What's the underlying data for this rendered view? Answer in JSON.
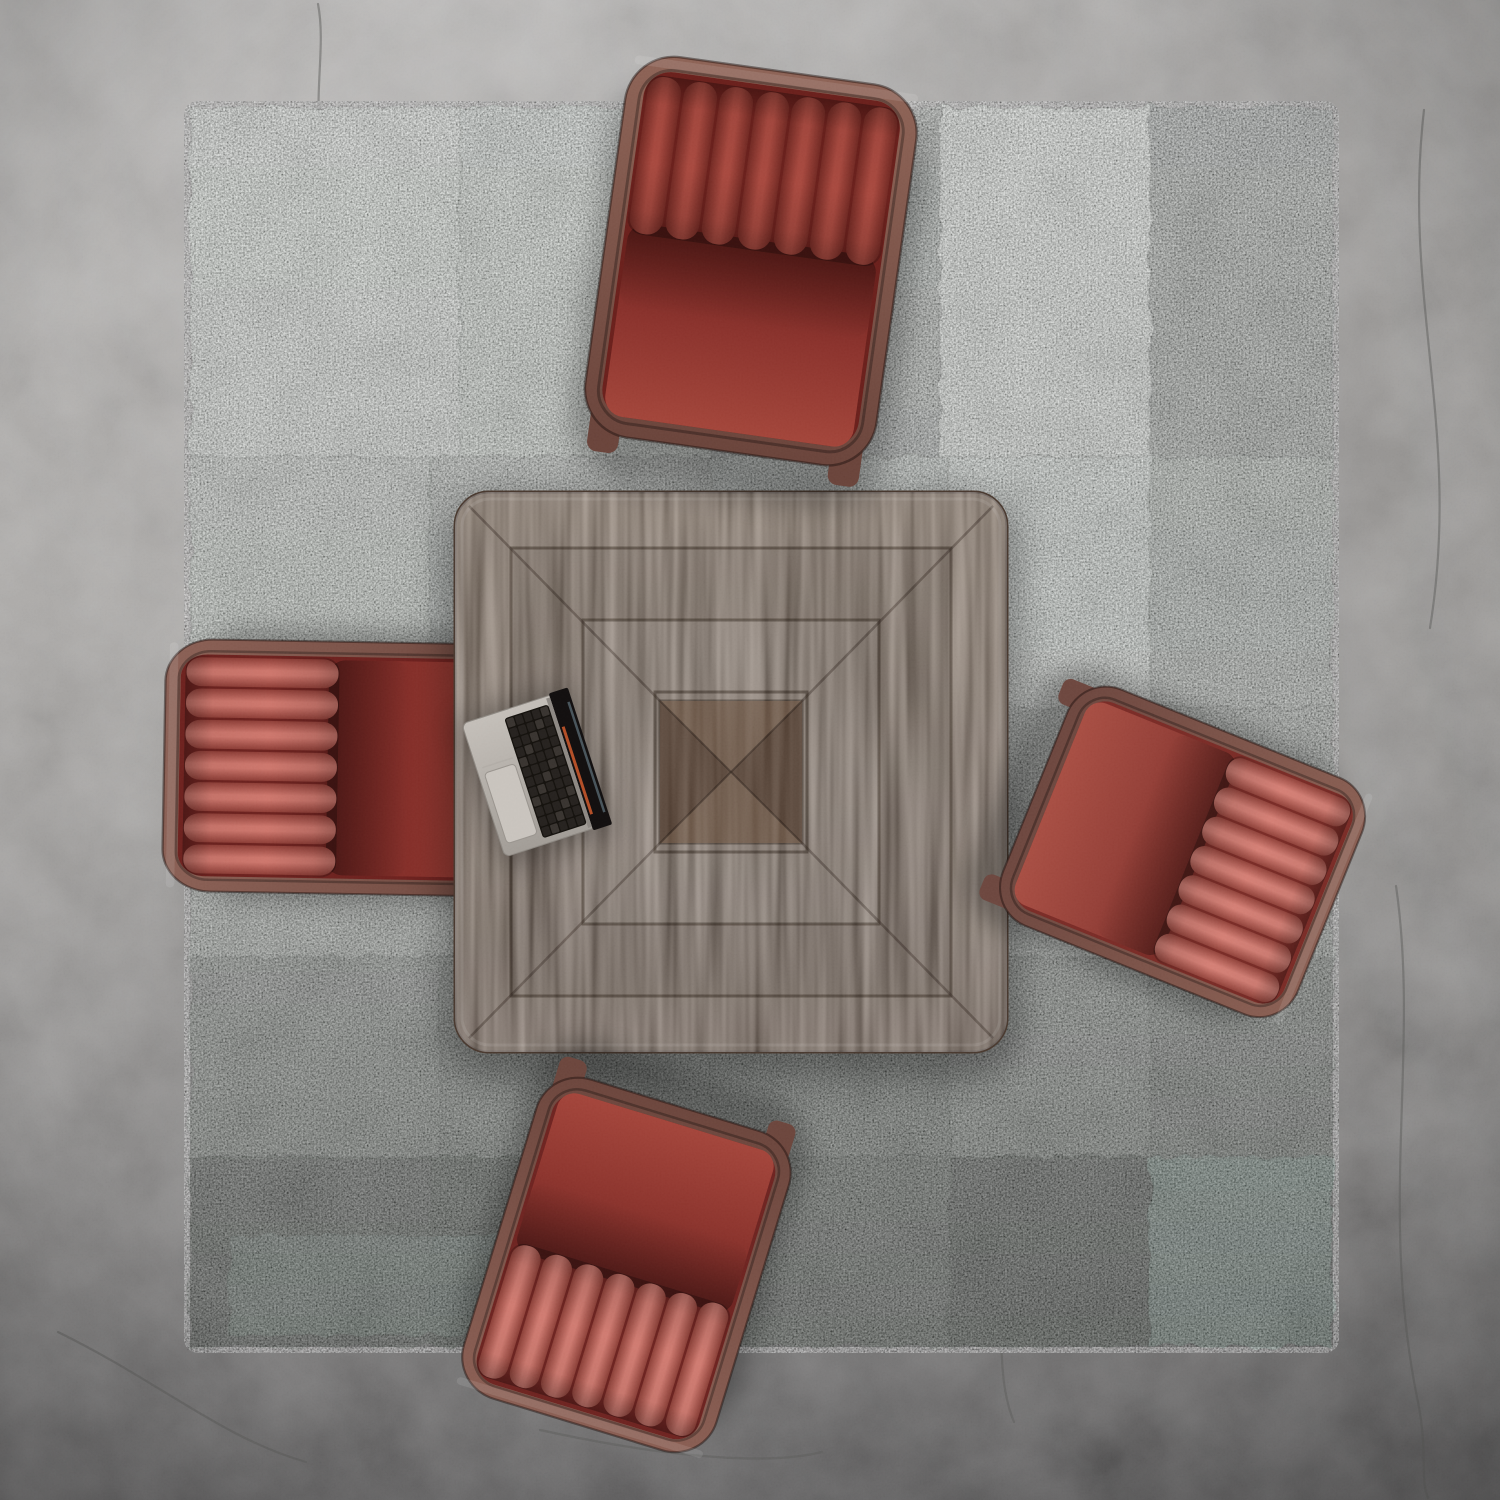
{
  "scene": {
    "description": "Top-down render: square walnut marquetry table with an open laptop, surrounded by four red leather channel-tufted wood-frame armchairs, on a distressed grey patchwork rug over a cracked concrete floor",
    "canvas": {
      "w": 1500,
      "h": 1500
    },
    "floor": {
      "base": "#a6a4a2",
      "crack": "#5e5d5b",
      "cracks": [
        "M318,4 C330,66 296,140 352,228",
        "M1424,110 C1402,300 1462,430 1430,628",
        "M1396,886 C1420,1050 1378,1210 1418,1402 C1428,1452 1420,1480 1428,1498",
        "M58,1332 C160,1382 222,1438 306,1462",
        "M540,1430 C640,1452 758,1468 822,1452",
        "M986,1236 C1010,1300 992,1370 1014,1422"
      ]
    },
    "rug": {
      "x": 190,
      "y": 107,
      "w": 1143,
      "h": 1240,
      "base": "#b4bab4",
      "seam": "rgba(25,30,25,0.13)",
      "patches": [
        {
          "x": 0,
          "y": 0,
          "w": 270,
          "h": 350,
          "c": "#d4dad4"
        },
        {
          "x": 270,
          "y": 0,
          "w": 250,
          "h": 350,
          "c": "#c7cfc8"
        },
        {
          "x": 520,
          "y": 0,
          "w": 230,
          "h": 350,
          "c": "#9ba19c"
        },
        {
          "x": 750,
          "y": 0,
          "w": 210,
          "h": 350,
          "c": "#d8ded8"
        },
        {
          "x": 960,
          "y": 0,
          "w": 183,
          "h": 350,
          "c": "#8e948f"
        },
        {
          "x": 0,
          "y": 350,
          "w": 240,
          "h": 250,
          "c": "#c1c8c2"
        },
        {
          "x": 240,
          "y": 350,
          "w": 280,
          "h": 250,
          "c": "#abb2ac"
        },
        {
          "x": 520,
          "y": 350,
          "w": 240,
          "h": 250,
          "c": "#b7beb8"
        },
        {
          "x": 760,
          "y": 350,
          "w": 200,
          "h": 250,
          "c": "#d0d7d1"
        },
        {
          "x": 960,
          "y": 350,
          "w": 183,
          "h": 250,
          "c": "#a3aaa4"
        },
        {
          "x": 0,
          "y": 600,
          "w": 260,
          "h": 250,
          "c": "#b1b7b1"
        },
        {
          "x": 260,
          "y": 600,
          "w": 260,
          "h": 250,
          "c": "#a5aba5"
        },
        {
          "x": 520,
          "y": 600,
          "w": 250,
          "h": 250,
          "c": "#9aa09a"
        },
        {
          "x": 770,
          "y": 600,
          "w": 190,
          "h": 250,
          "c": "#afb5af"
        },
        {
          "x": 960,
          "y": 600,
          "w": 183,
          "h": 250,
          "c": "#989e98"
        },
        {
          "x": 0,
          "y": 850,
          "w": 250,
          "h": 200,
          "c": "#8e948e"
        },
        {
          "x": 250,
          "y": 850,
          "w": 270,
          "h": 200,
          "c": "#838983"
        },
        {
          "x": 520,
          "y": 850,
          "w": 240,
          "h": 200,
          "c": "#7a807a"
        },
        {
          "x": 760,
          "y": 850,
          "w": 200,
          "h": 200,
          "c": "#888e88"
        },
        {
          "x": 960,
          "y": 850,
          "w": 183,
          "h": 200,
          "c": "#747a74"
        },
        {
          "x": 0,
          "y": 1050,
          "w": 240,
          "h": 190,
          "c": "#5e645e"
        },
        {
          "x": 240,
          "y": 1050,
          "w": 280,
          "h": 190,
          "c": "#555b55"
        },
        {
          "x": 520,
          "y": 1050,
          "w": 240,
          "h": 190,
          "c": "#6a706a"
        },
        {
          "x": 760,
          "y": 1050,
          "w": 200,
          "h": 190,
          "c": "#515751"
        },
        {
          "x": 960,
          "y": 1050,
          "w": 183,
          "h": 190,
          "c": "#7e968d"
        },
        {
          "x": 40,
          "y": 1128,
          "w": 470,
          "h": 100,
          "c": "#87a096",
          "o": 0.55
        },
        {
          "x": 560,
          "y": 470,
          "w": 180,
          "h": 130,
          "c": "#c9d0ca",
          "o": 0.5
        }
      ]
    },
    "table": {
      "x": 455,
      "y": 492,
      "w": 552,
      "h": 560,
      "r": 34,
      "wood": "#74604f",
      "woodDark": "#5e4b3d",
      "edge": "#4a3a30",
      "seams": [
        56,
        128,
        200
      ],
      "seam_color": "rgba(44,33,25,0.5)",
      "center_size": 142,
      "center_base": "#5e4a3d",
      "center_light": "#6b5748",
      "center_dark": "#564438"
    },
    "laptop": {
      "cx": 531,
      "cy": 775,
      "rot": -18,
      "deck_light": "#c4bfb9",
      "deck_dark": "#a29d97",
      "keyboard": "#16130f",
      "key": "#272320",
      "key_edge": "#3a3531",
      "trackpad": "#c9c4be",
      "hinge": "#8e8984",
      "screen": "#131010",
      "screen_accent_orange": "#b44f28",
      "screen_accent_blue": "#49555c",
      "rows": 12,
      "cols": 5
    },
    "chairs": [
      {
        "name": "armchair-top",
        "cx": 750,
        "cy": 267,
        "rot": 8,
        "sx": 0.98,
        "sy": 0.99,
        "wood": "#8e6457",
        "woodDark": "#6b453c",
        "seat": "#8c342e",
        "seatHi": "#a3463b",
        "seatDeep": "#6b211d",
        "channelHi": "#a84a40",
        "channelDark": "#752b25"
      },
      {
        "name": "armchair-left",
        "cx": 354,
        "cy": 768,
        "rot": -89,
        "sx": 0.84,
        "sy": 0.95,
        "wood": "#8b6156",
        "woodDark": "#6e483f",
        "seat": "#89322c",
        "seatHi": "#9e443a",
        "seatDeep": "#6e2320",
        "channelHi": "#cd776d",
        "channelDark": "#8f3f38"
      },
      {
        "name": "armchair-right",
        "cx": 1178,
        "cy": 850,
        "rot": 112,
        "sx": 0.85,
        "sy": 0.82,
        "wood": "#8a6054",
        "woodDark": "#6e4840",
        "seat": "#96423a",
        "seatHi": "#a84f44",
        "seatDeep": "#7b2d28",
        "channelHi": "#d48076",
        "channelDark": "#94453d"
      },
      {
        "name": "armchair-bottom",
        "cx": 628,
        "cy": 1260,
        "rot": 197,
        "sx": 0.88,
        "sy": 0.86,
        "wood": "#8a5f54",
        "woodDark": "#6d473e",
        "seat": "#8e362f",
        "seatHi": "#a4463c",
        "seatDeep": "#6f2522",
        "channelHi": "#d07c72",
        "channelDark": "#8f423a"
      }
    ]
  }
}
